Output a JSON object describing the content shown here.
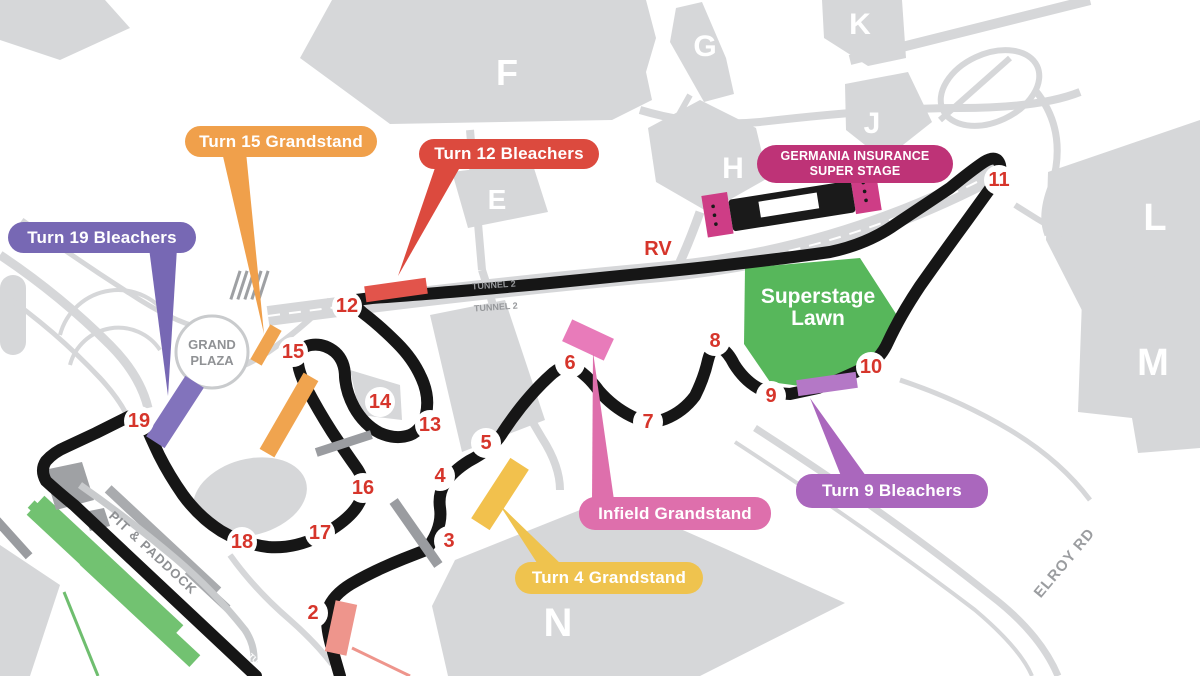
{
  "venue_map": {
    "labels": {
      "turn15_grandstand": "Turn 15 Grandstand",
      "turn12_bleachers": "Turn 12 Bleachers",
      "turn19_bleachers": "Turn 19 Bleachers",
      "germania_line1": "GERMANIA INSURANCE",
      "germania_line2": "SUPER STAGE",
      "infield_grandstand": "Infield Grandstand",
      "turn9_bleachers": "Turn 9 Bleachers",
      "turn4_grandstand": "Turn 4 Grandstand"
    },
    "areas": {
      "superstage_lawn_line1": "Superstage",
      "superstage_lawn_line2": "Lawn",
      "grand_plaza_line1": "GRAND",
      "grand_plaza_line2": "PLAZA",
      "pit_paddock": "PIT & PADDOCK",
      "rv_area": "RV",
      "elroy_road": "ELROY RD",
      "tunnel2_upper": "TUNNEL 2",
      "tunnel2_lower": "TUNNEL 2",
      "tunnel1": "TUNNEL 1"
    },
    "parking_lots": [
      "F",
      "G",
      "K",
      "J",
      "H",
      "E",
      "L",
      "M",
      "N"
    ],
    "turn_numbers": [
      "2",
      "3",
      "4",
      "5",
      "6",
      "7",
      "8",
      "9",
      "10",
      "11",
      "12",
      "13",
      "14",
      "15",
      "16",
      "17",
      "18",
      "19"
    ],
    "colors": {
      "track": "#161616",
      "roads_lots": "#D6D7D9",
      "turn_number_red": "#D6352B",
      "turn15_orange": "#F0A04B",
      "turn12_red": "#DC4A3E",
      "turn19_purple": "#7768B4",
      "turn4_yellow": "#EFC34E",
      "infield_pink": "#DE6FAC",
      "turn9_orchid": "#AA67BD",
      "germania_magenta": "#BE3377",
      "lawn_green": "#57B75B",
      "grandstand_green": "#72C271"
    }
  }
}
